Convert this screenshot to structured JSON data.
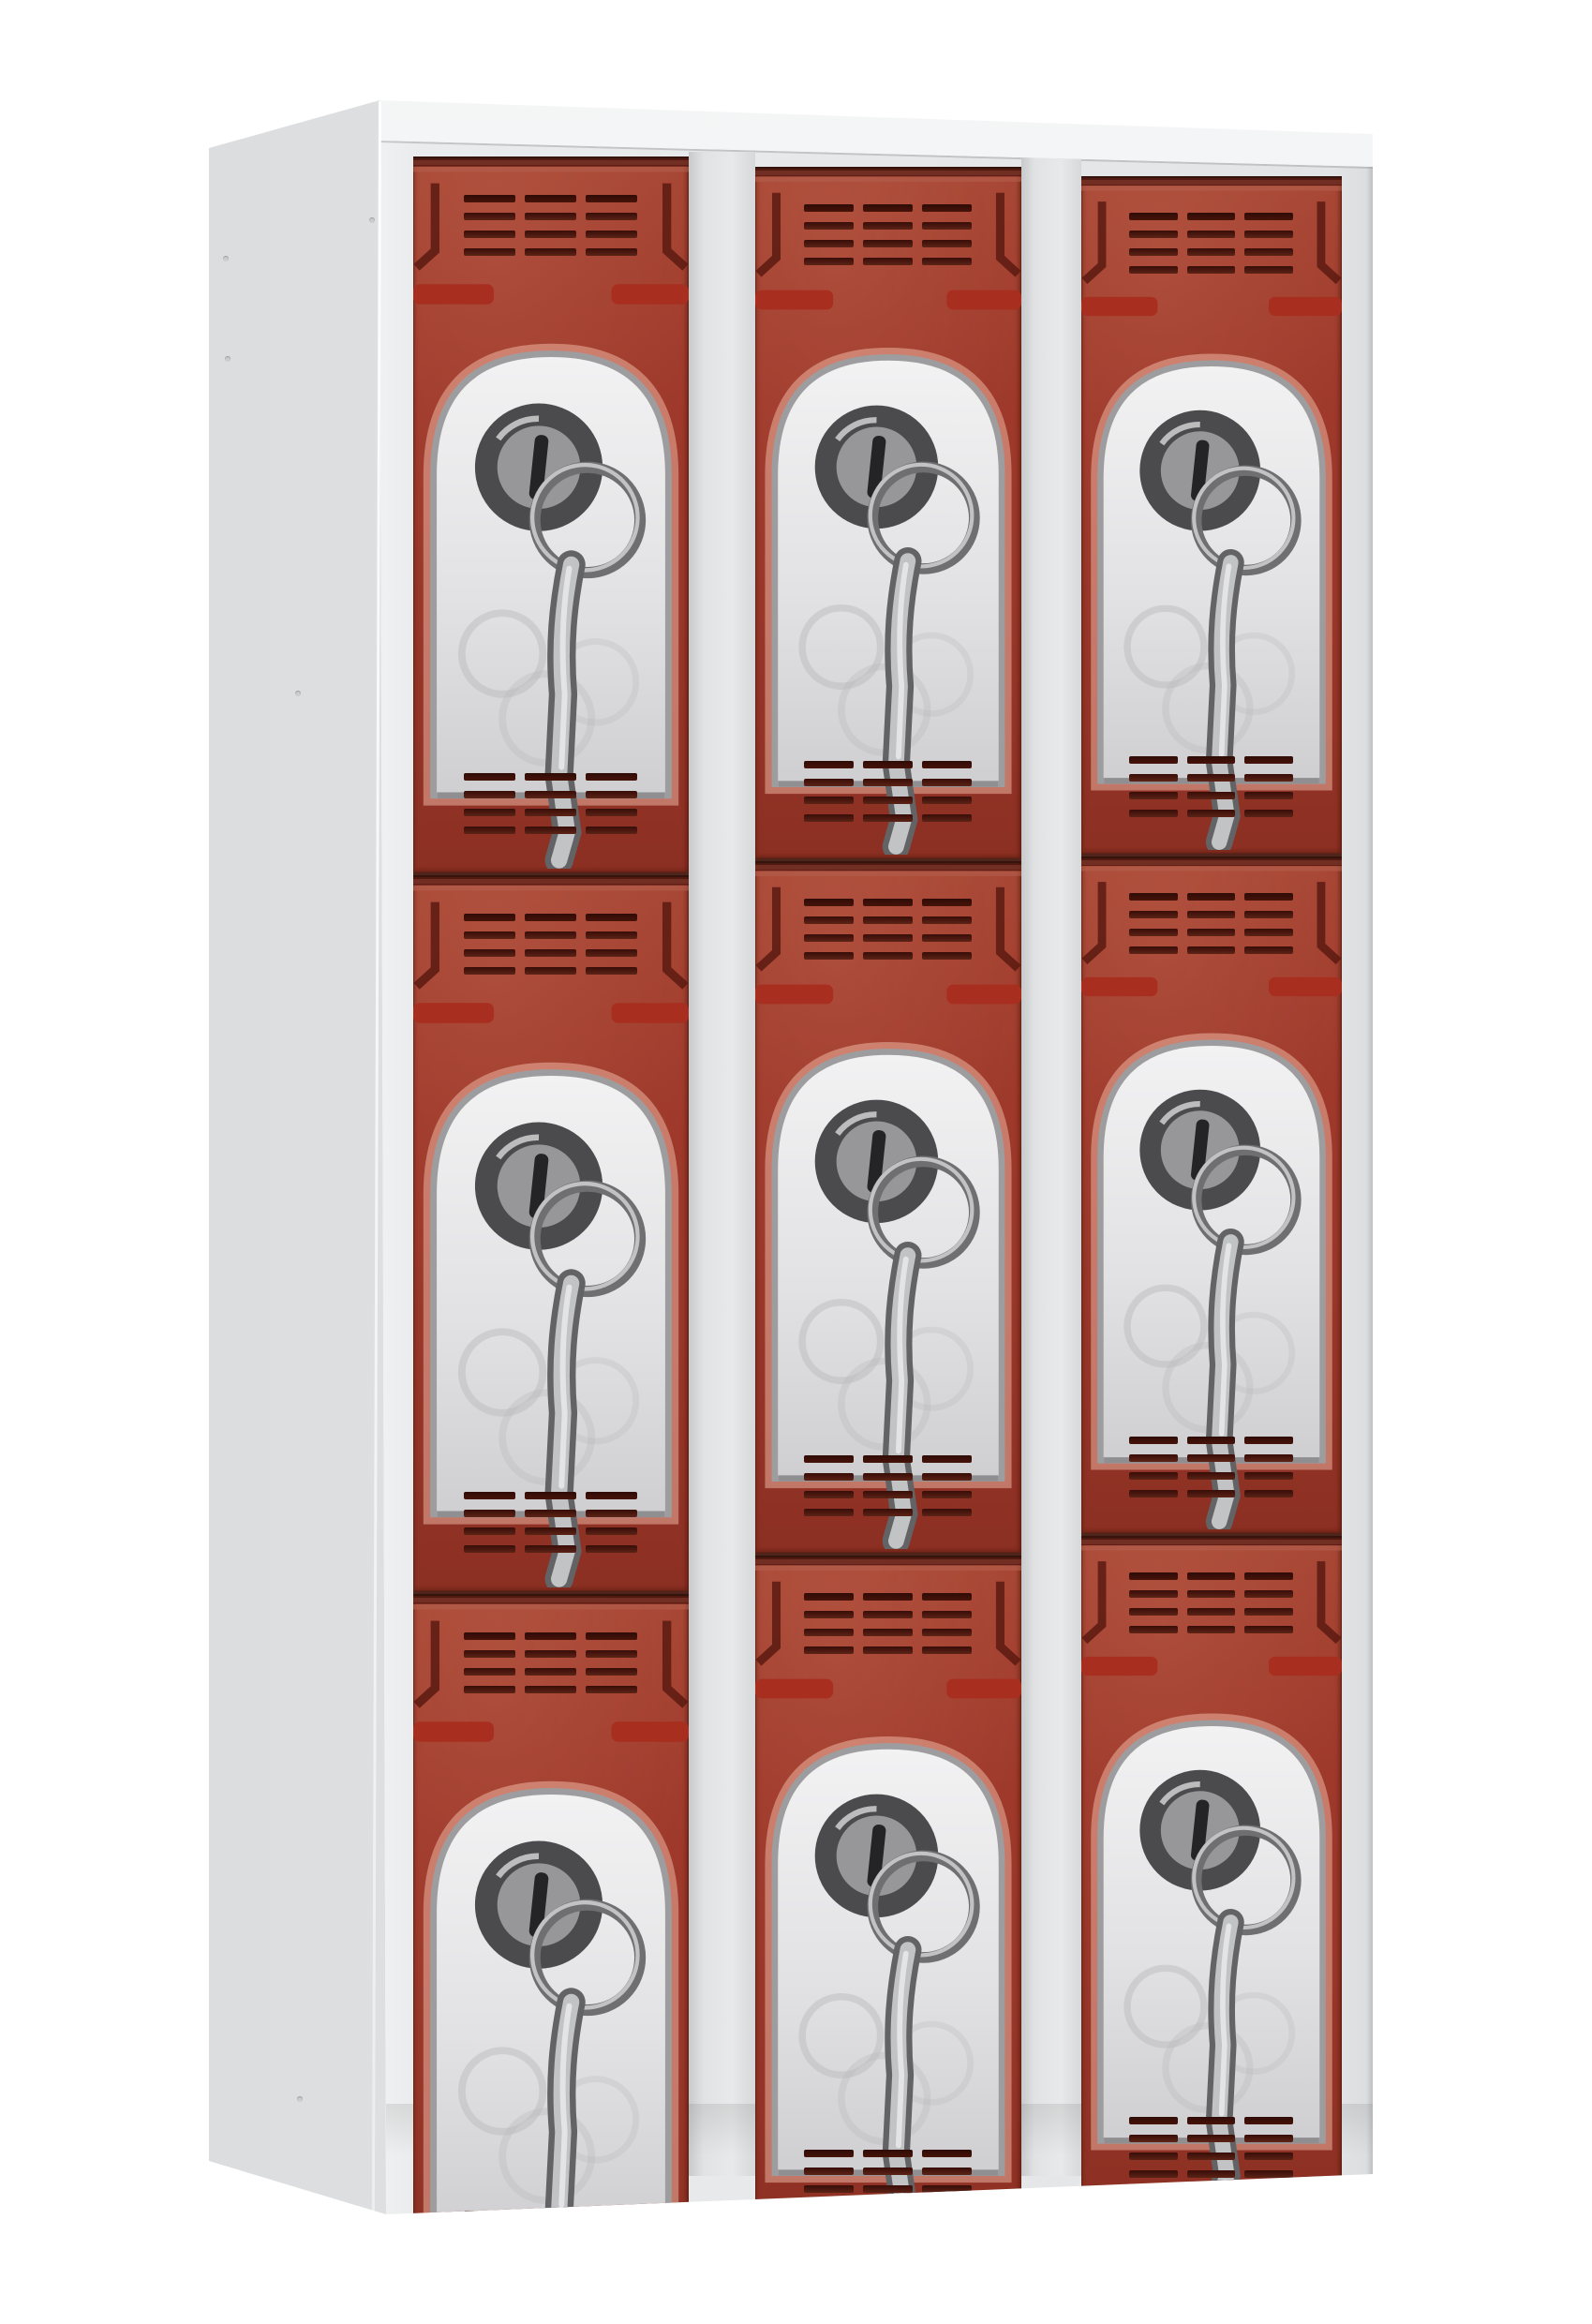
{
  "image": {
    "type": "product-photo",
    "subject": "multi-compartment metal locker cabinet with red doors",
    "background": "#ffffff"
  },
  "locker": {
    "columns": 3,
    "rows": 3,
    "door_count": 9,
    "features_per_door": {
      "top_vent_grille": {
        "groups": 3,
        "slots_per_group": 4
      },
      "bottom_vent_grille": {
        "groups": 3,
        "slots_per_group": 4
      },
      "handle": "stamped-recess-handle",
      "lock": "cam-lock-with-hanging-key",
      "hinges_per_door": 2
    },
    "icons": [
      "vent-grille-icon",
      "handle-icon",
      "lock-icon",
      "key-icon",
      "hinge-icon"
    ],
    "colors": {
      "background": "#ffffff",
      "door_red": "#9e392b",
      "door_red_light": "#a84735",
      "door_red_dark": "#8c3023",
      "vent_slot_dark": "#380d08",
      "vent_slot_maroon": "#5c2316",
      "handle_outline": "#5a1a11",
      "handle_foot": "#a82e1f",
      "hinge_tab_red": "#97301f",
      "hinge_tab_white": "#f3f4f5",
      "frame_light": "#e7e9ea",
      "frame_gap": "#dcdee0",
      "side_panel": "#e3e5e7",
      "top_panel": "#eef0f1",
      "seam_dark": "#4e241b",
      "lock_body": "#dededf",
      "lock_outline": "#9d9da0",
      "key_metal": "#c2c3c5",
      "cylinder_dark": "#4b4b4e"
    }
  }
}
